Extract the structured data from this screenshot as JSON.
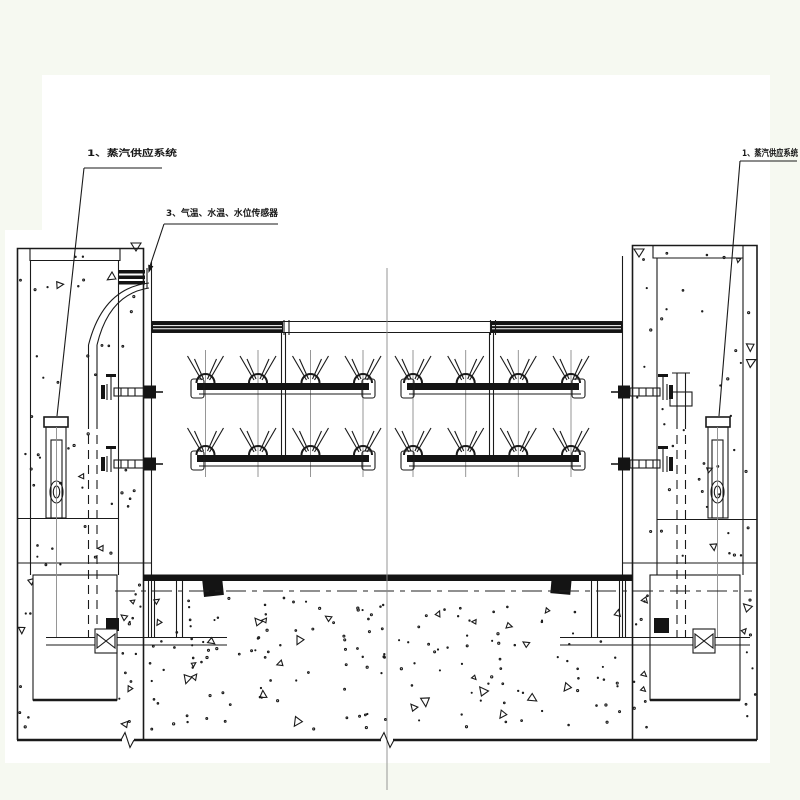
{
  "drawing": {
    "kind": "engineering-cross-section",
    "colors": {
      "ink": "#1a1a1a",
      "paper": "#ffffff",
      "margin": "#f6f9f1",
      "faint_line": "#8b8b8b"
    }
  },
  "annotations": {
    "left_steam": "1、蒸汽供应系统",
    "sensors": "3、气温、水温、水位传感器",
    "right_steam": "1、蒸汽供应系统"
  }
}
